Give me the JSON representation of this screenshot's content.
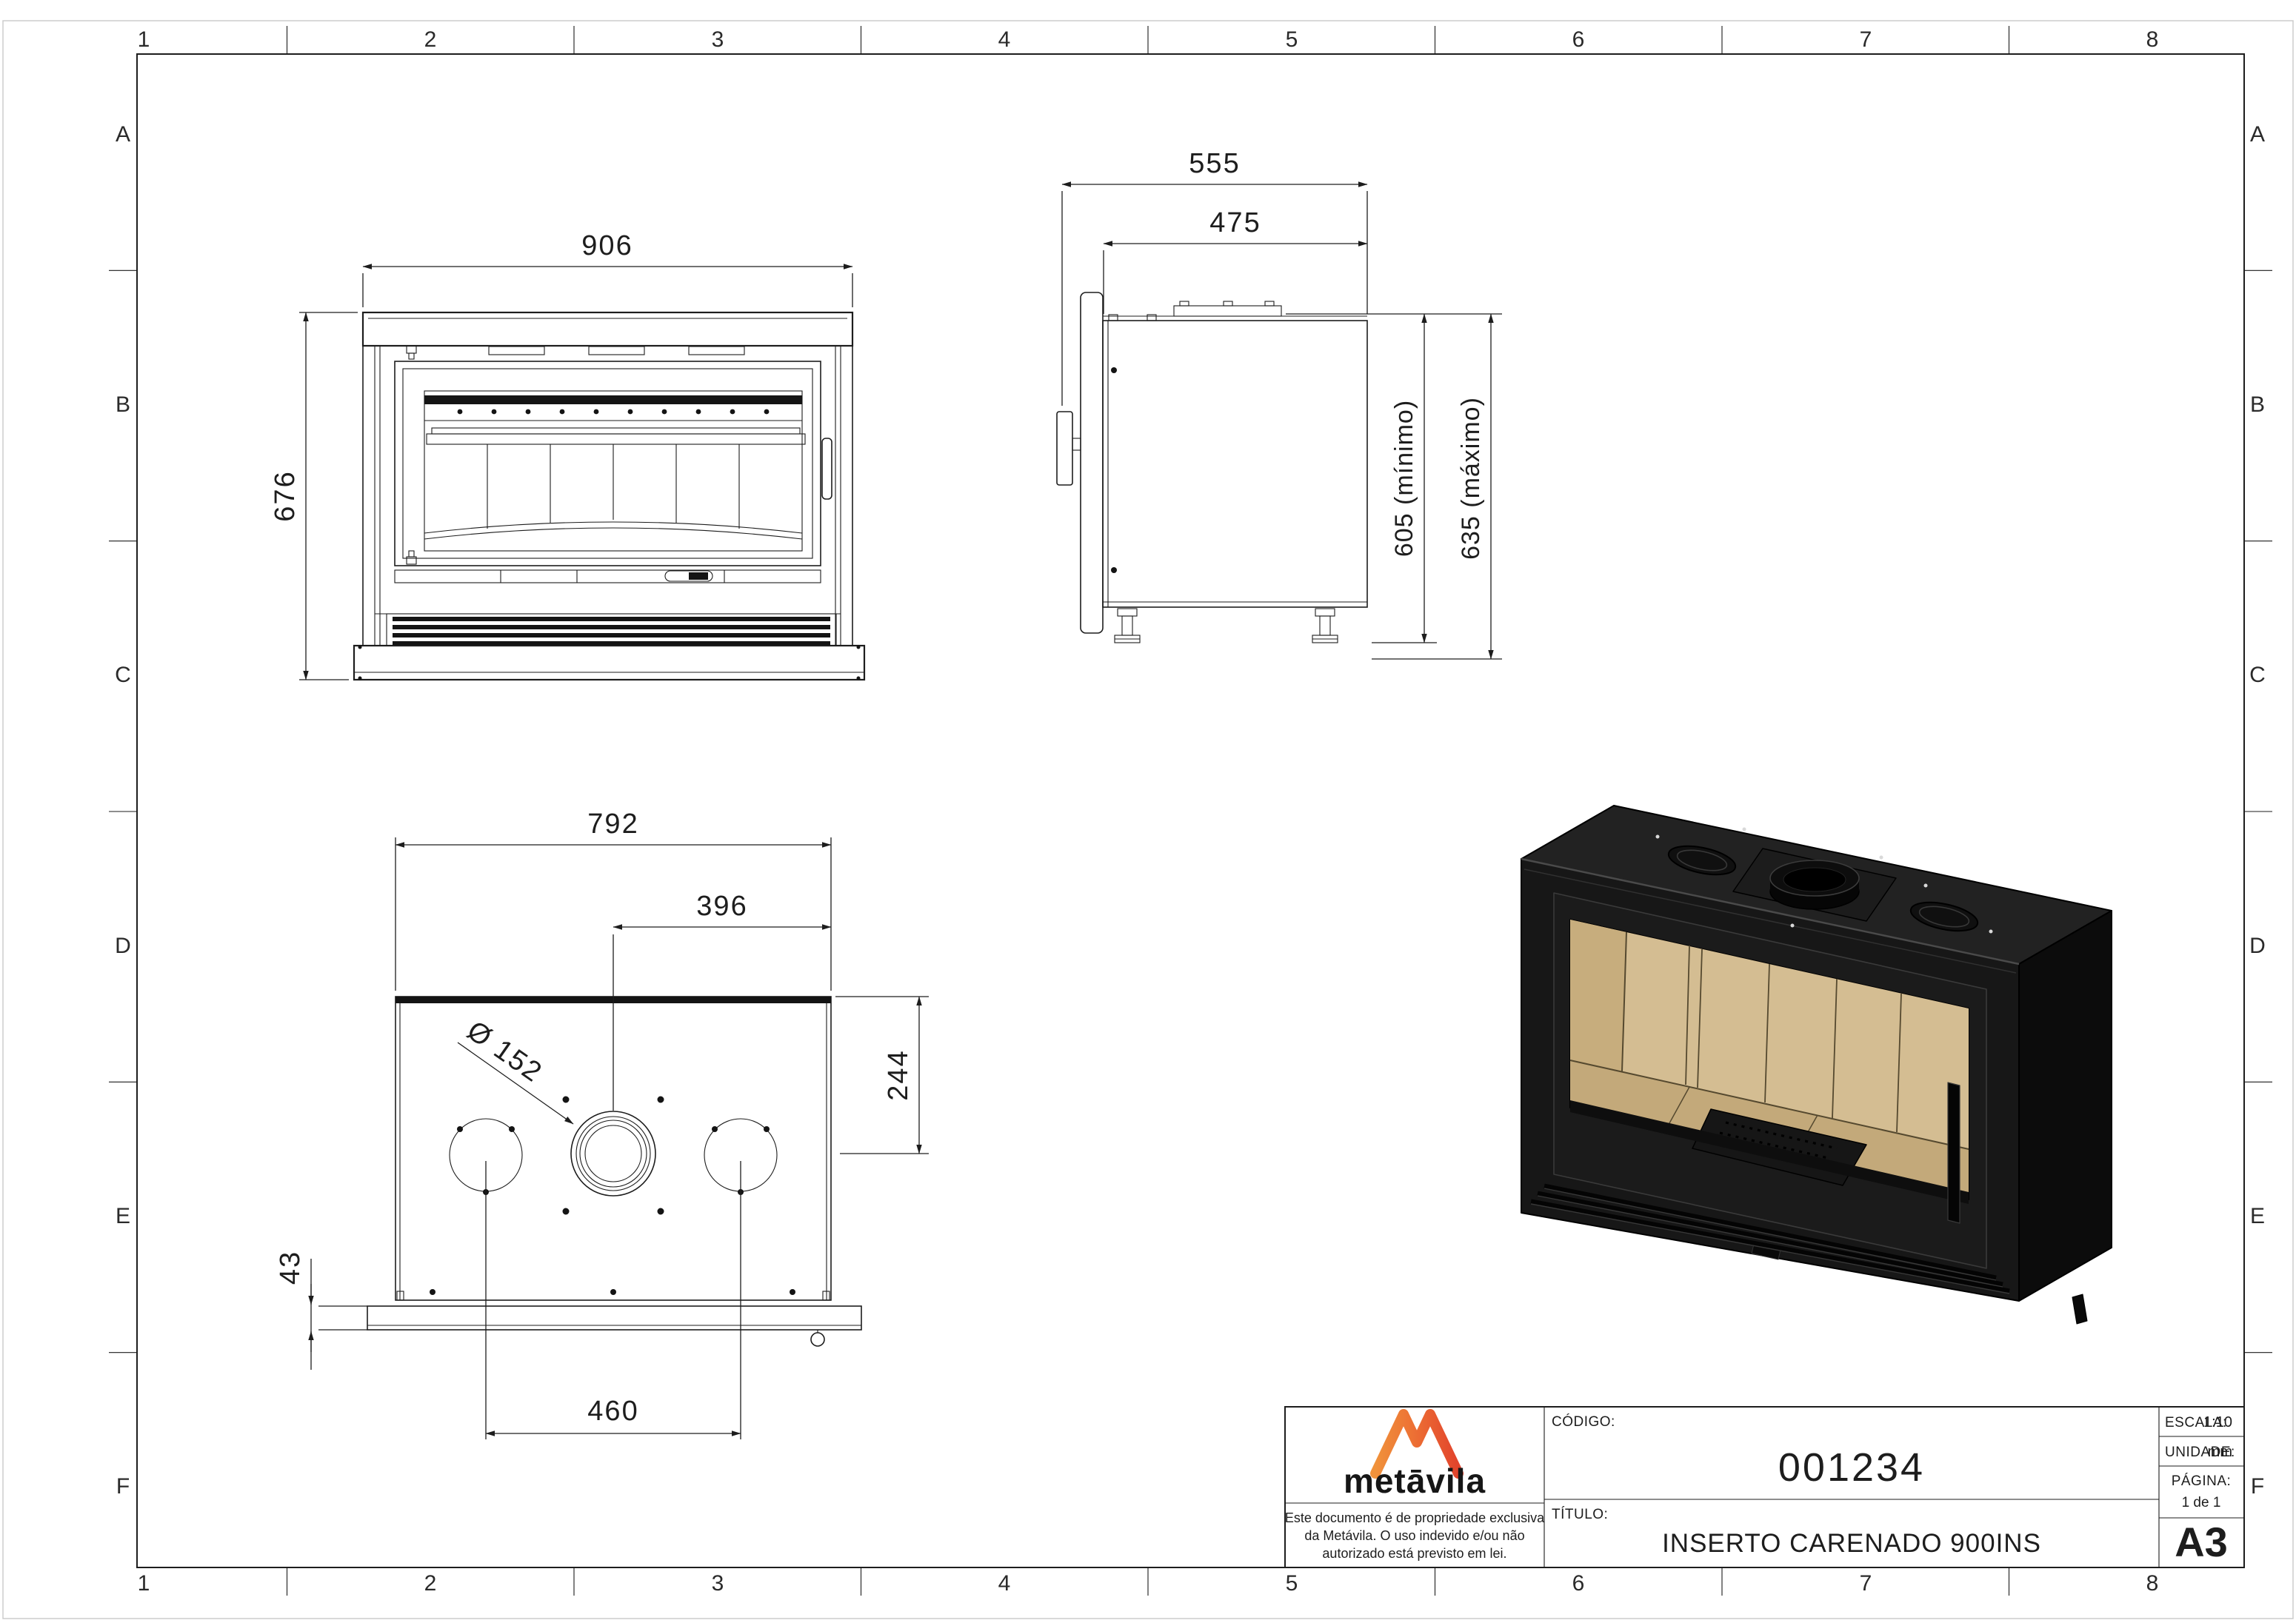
{
  "sheet": {
    "cols": [
      "1",
      "2",
      "3",
      "4",
      "5",
      "6",
      "7",
      "8"
    ],
    "rows": [
      "A",
      "B",
      "C",
      "D",
      "E",
      "F"
    ]
  },
  "views": {
    "front": {
      "width": "906",
      "height": "676"
    },
    "side": {
      "depth": "555",
      "depth_inner": "475",
      "height_min": "605 (mínimo)",
      "height_max": "635 (máximo)"
    },
    "top": {
      "width": "792",
      "center_offset": "396",
      "flue_dia": "Ø 152",
      "rear_offset": "244",
      "lip": "43",
      "duct_spacing": "460"
    }
  },
  "title_block": {
    "logo": {
      "wordmark": "metāvila"
    },
    "disclaimer": [
      "Este documento é de propriedade exclusiva",
      "da Metávila. O uso indevido e/ou não",
      "autorizado está previsto em lei."
    ],
    "codigo": {
      "label": "CÓDIGO:",
      "value": "001234"
    },
    "titulo": {
      "label": "TÍTULO:",
      "value": "INSERTO CARENADO 900INS"
    },
    "escala": {
      "label": "ESCALA:",
      "value": "1:10"
    },
    "unidade": {
      "label": "UNIDADE:",
      "value": "mm"
    },
    "pagina": {
      "label": "PÁGINA:",
      "value": "1 de 1"
    },
    "formato": "A3"
  },
  "colors": {
    "paper": "#ffffff",
    "ink": "#1d1d1d",
    "unit_black": "#171717",
    "firebrick_tan": "#d4bd92",
    "logo_orange": "#f0923b",
    "logo_red": "#e2432c"
  }
}
